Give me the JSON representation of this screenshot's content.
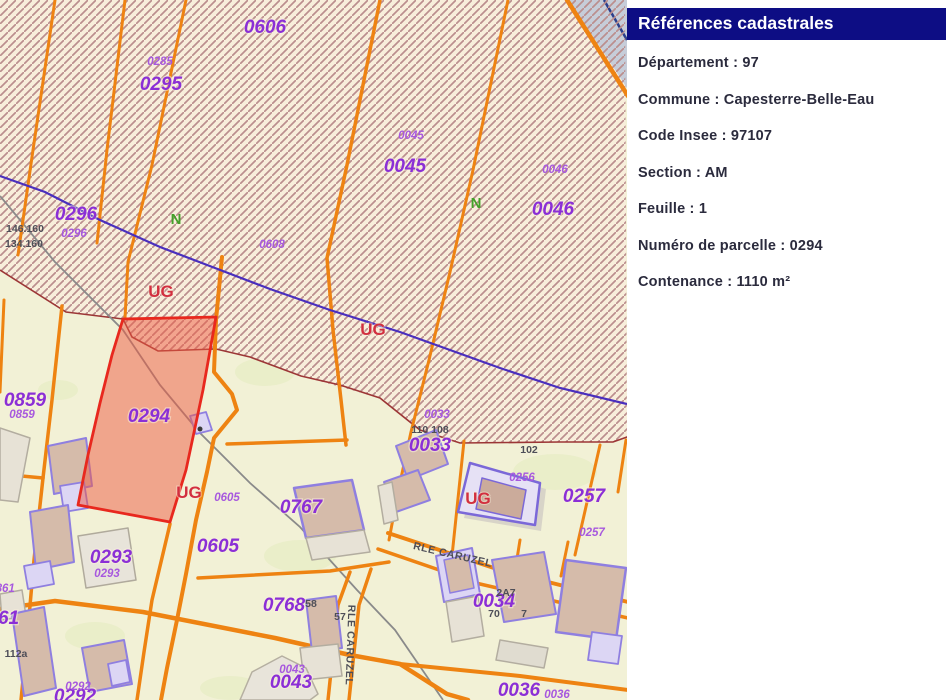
{
  "panel": {
    "title": "Références cadastrales",
    "rows": [
      {
        "text": "Département : 97"
      },
      {
        "text": "Commune : Capesterre-Belle-Eau"
      },
      {
        "text": "Code Insee : 97107"
      },
      {
        "text": "Section : AM"
      },
      {
        "text": "Feuille : 1"
      },
      {
        "text": "Numéro de parcelle : 0294"
      },
      {
        "text": "Contenance : 1110 m²"
      }
    ]
  },
  "map": {
    "selected_parcel": {
      "id": "0294",
      "fill": "rgba(238,90,66,0.5)",
      "stroke": "#e8281e"
    },
    "colors": {
      "panel_blue": "#0d0d84",
      "parcel_label_purple": "#8b2fd6",
      "parcel_label_small_purple": "#a758de",
      "zone_ug_red": "#d22f3f",
      "zone_n_green": "#44a02a",
      "road_orange": "#ee8312",
      "hatch_line": "#bb8e8e",
      "hatch_bg": "#f8eedb",
      "parcel_bg": "#f2f1d6",
      "road_purple": "#4a2fbd",
      "building_tan": "#d5bbaa",
      "building_outline": "#8f7fe0"
    },
    "labels": [
      {
        "t": "0606",
        "x": 265,
        "y": 33,
        "c": "big"
      },
      {
        "t": "0295",
        "x": 161,
        "y": 90,
        "c": "big"
      },
      {
        "t": "0296",
        "x": 76,
        "y": 220,
        "c": "big"
      },
      {
        "t": "0045",
        "x": 405,
        "y": 172,
        "c": "big"
      },
      {
        "t": "0046",
        "x": 553,
        "y": 215,
        "c": "big"
      },
      {
        "t": "0859",
        "x": 25,
        "y": 406,
        "c": "big"
      },
      {
        "t": "0294",
        "x": 149,
        "y": 422,
        "c": "big",
        "n": "selected-parcel-label"
      },
      {
        "t": "0293",
        "x": 111,
        "y": 563,
        "c": "big"
      },
      {
        "t": "0605",
        "x": 218,
        "y": 552,
        "c": "big"
      },
      {
        "t": "0767",
        "x": 301,
        "y": 513,
        "c": "big"
      },
      {
        "t": "0768",
        "x": 284,
        "y": 611,
        "c": "big"
      },
      {
        "t": "0043",
        "x": 291,
        "y": 688,
        "c": "big"
      },
      {
        "t": "0033",
        "x": 430,
        "y": 451,
        "c": "big"
      },
      {
        "t": "0257",
        "x": 584,
        "y": 502,
        "c": "big"
      },
      {
        "t": "0034",
        "x": 494,
        "y": 607,
        "c": "big"
      },
      {
        "t": "0036",
        "x": 519,
        "y": 696,
        "c": "big"
      },
      {
        "t": "0861",
        "x": -2,
        "y": 624,
        "c": "big"
      },
      {
        "t": "0292",
        "x": 75,
        "y": 702,
        "c": "big"
      },
      {
        "t": "0285",
        "x": 160,
        "y": 65,
        "c": "small"
      },
      {
        "t": "0045",
        "x": 411,
        "y": 139,
        "c": "small"
      },
      {
        "t": "0046",
        "x": 555,
        "y": 173,
        "c": "small"
      },
      {
        "t": "0608",
        "x": 272,
        "y": 248,
        "c": "small"
      },
      {
        "t": "0296",
        "x": 74,
        "y": 237,
        "c": "small"
      },
      {
        "t": "0859",
        "x": 22,
        "y": 418,
        "c": "small"
      },
      {
        "t": "0605",
        "x": 227,
        "y": 501,
        "c": "small"
      },
      {
        "t": "0293",
        "x": 107,
        "y": 577,
        "c": "small"
      },
      {
        "t": "0292",
        "x": 78,
        "y": 690,
        "c": "small"
      },
      {
        "t": "0033",
        "x": 437,
        "y": 418,
        "c": "small"
      },
      {
        "t": "0256",
        "x": 522,
        "y": 481,
        "c": "small"
      },
      {
        "t": "0257",
        "x": 592,
        "y": 536,
        "c": "small"
      },
      {
        "t": "0036",
        "x": 557,
        "y": 698,
        "c": "small"
      },
      {
        "t": "0043",
        "x": 292,
        "y": 673,
        "c": "small"
      },
      {
        "t": "0861",
        "x": 2,
        "y": 592,
        "c": "small"
      },
      {
        "t": "146.160",
        "x": 25,
        "y": 232,
        "c": "dark"
      },
      {
        "t": "134.160",
        "x": 24,
        "y": 247,
        "c": "dark"
      },
      {
        "t": "110 108",
        "x": 430,
        "y": 433,
        "c": "dark"
      },
      {
        "t": "102",
        "x": 529,
        "y": 453,
        "c": "dark"
      },
      {
        "t": "112a",
        "x": 16,
        "y": 657,
        "c": "dark"
      },
      {
        "t": "58",
        "x": 311,
        "y": 607,
        "c": "dark"
      },
      {
        "t": "57",
        "x": 340,
        "y": 620,
        "c": "dark"
      },
      {
        "t": "2A7",
        "x": 506,
        "y": 596,
        "c": "dark"
      },
      {
        "t": "70",
        "x": 494,
        "y": 617,
        "c": "dark"
      },
      {
        "t": "7",
        "x": 524,
        "y": 617,
        "c": "dark"
      },
      {
        "t": "UG",
        "x": 161,
        "y": 297,
        "c": "ug",
        "n": "zone-ug-label"
      },
      {
        "t": "UG",
        "x": 373,
        "y": 335,
        "c": "ug",
        "n": "zone-ug-label"
      },
      {
        "t": "UG",
        "x": 189,
        "y": 498,
        "c": "ug",
        "n": "zone-ug-label"
      },
      {
        "t": "UG",
        "x": 478,
        "y": 504,
        "c": "ug",
        "n": "zone-ug-label"
      },
      {
        "t": "N",
        "x": 176,
        "y": 224,
        "c": "n",
        "n": "zone-n-label"
      },
      {
        "t": "N",
        "x": 476,
        "y": 208,
        "c": "n",
        "n": "zone-n-label"
      },
      {
        "t": "RLE CARUZEL",
        "x": 452,
        "y": 558,
        "c": "street",
        "r": 13,
        "n": "street-name-label"
      },
      {
        "t": "RLE CARUZEL",
        "x": 347,
        "y": 645,
        "c": "street",
        "r": 92,
        "n": "street-name-label"
      }
    ]
  }
}
